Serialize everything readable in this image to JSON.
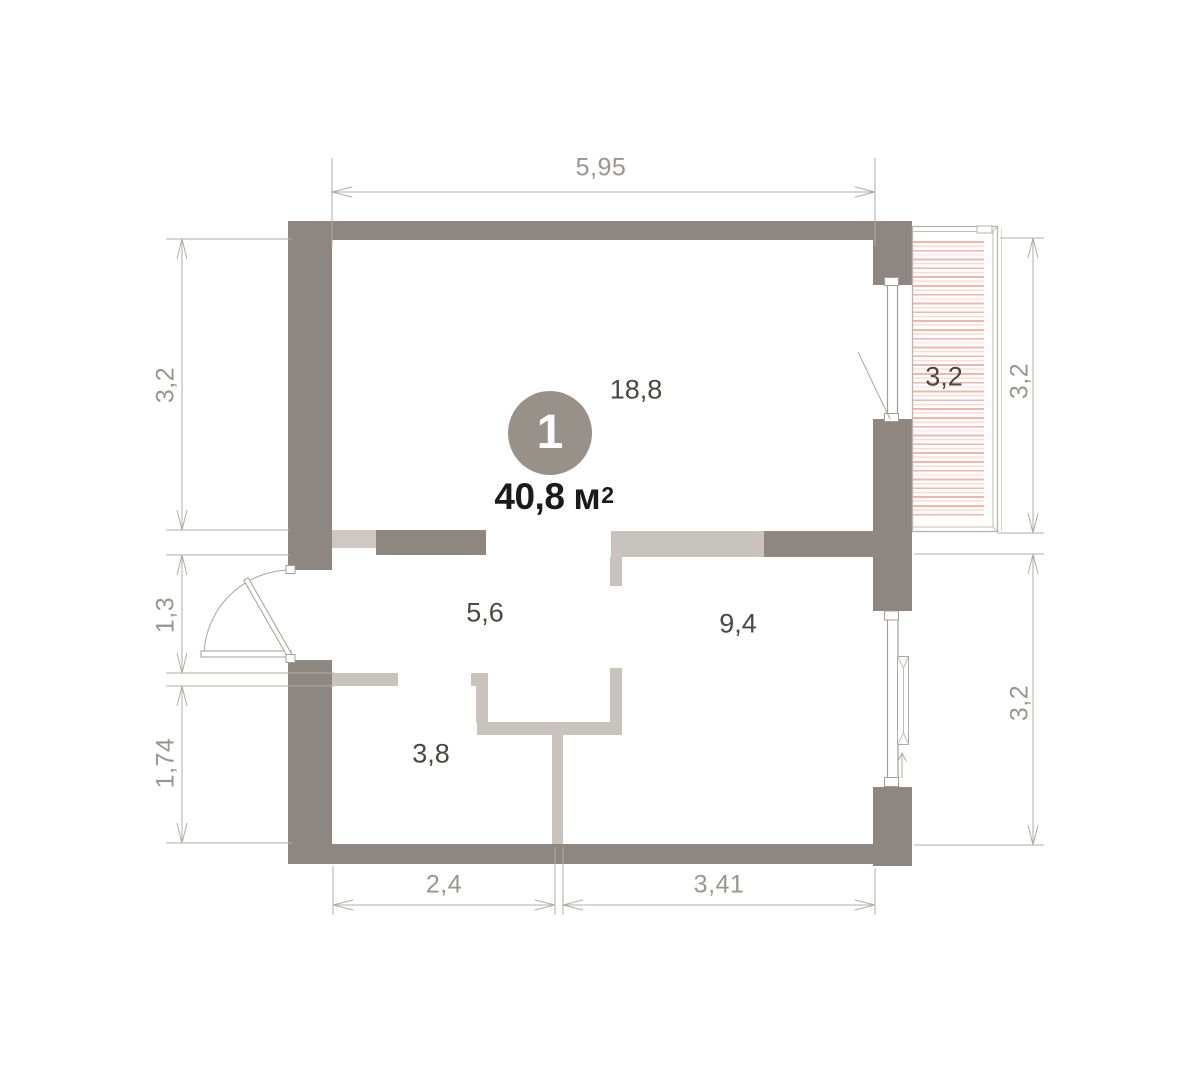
{
  "unit": {
    "number": "1",
    "area_value": "40,8",
    "area_unit": "м",
    "area_power": "2"
  },
  "rooms": {
    "living": "18,8",
    "hallway": "5,6",
    "bedroom": "9,4",
    "bathroom": "3,8",
    "balcony": "3,2"
  },
  "dimensions": {
    "top": "5,95",
    "left_upper": "3,2",
    "left_middle": "1,3",
    "left_lower": "1,74",
    "right_upper": "3,2",
    "right_lower": "3,2",
    "bottom_left": "2,4",
    "bottom_right": "3,41"
  },
  "colors": {
    "wall_dark": "#8e8781",
    "wall_light": "#c9c3bd",
    "hatch_pink": "#f0b6ab",
    "dim_line": "#b2aca6",
    "dim_text": "#9b958e",
    "room_text": "#4b4743",
    "area_text": "#1b1a19",
    "unit_circle": "#98918a"
  }
}
